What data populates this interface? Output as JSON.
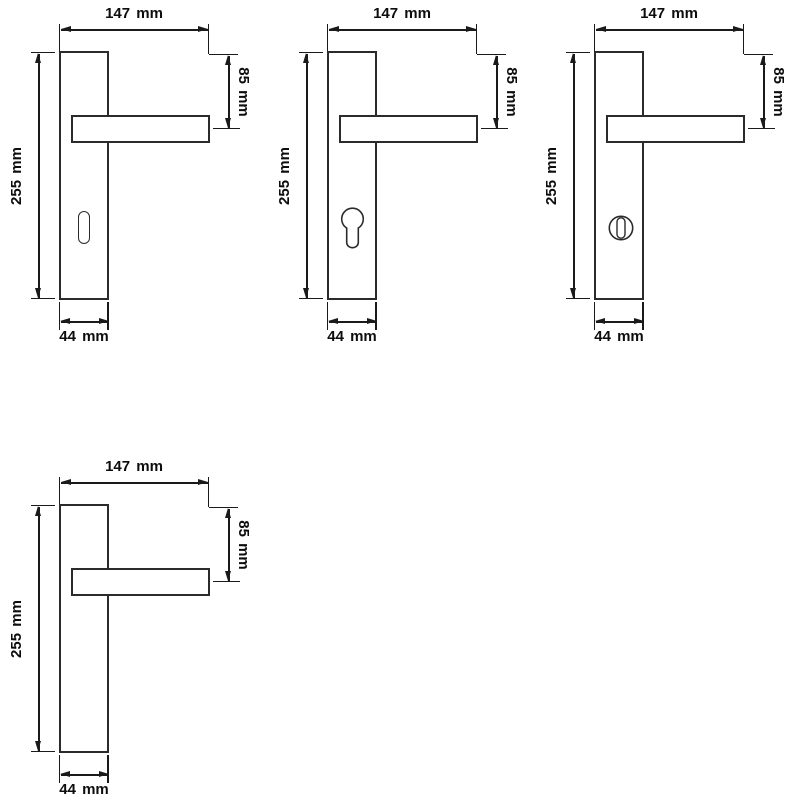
{
  "colors": {
    "line": "#1a1a1a",
    "outline": "#2b2b2b",
    "background": "#ffffff"
  },
  "drawings": [
    {
      "id": "keyhole-variant",
      "hole": "keyhole-icon",
      "dims": {
        "overall_width": "147 mm",
        "handle_offset": "85 mm",
        "plate_height": "255 mm",
        "plate_width": "44 mm"
      }
    },
    {
      "id": "euro-cylinder-variant",
      "hole": "euro-cylinder-icon",
      "dims": {
        "overall_width": "147 mm",
        "handle_offset": "85 mm",
        "plate_height": "255 mm",
        "plate_width": "44 mm"
      }
    },
    {
      "id": "wc-turn-variant",
      "hole": "wc-turn-icon",
      "dims": {
        "overall_width": "147 mm",
        "handle_offset": "85 mm",
        "plate_height": "255 mm",
        "plate_width": "44 mm"
      }
    },
    {
      "id": "blank-variant",
      "hole": "none",
      "dims": {
        "overall_width": "147 mm",
        "handle_offset": "85 mm",
        "plate_height": "255 mm",
        "plate_width": "44 mm"
      }
    }
  ]
}
